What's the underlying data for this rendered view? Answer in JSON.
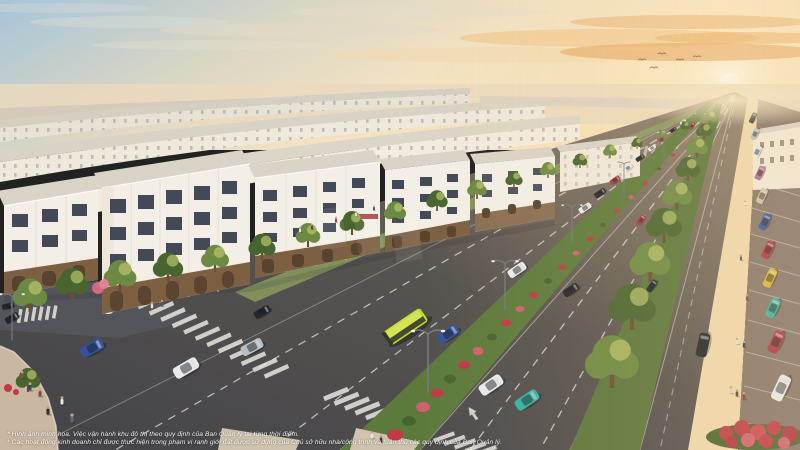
{
  "disclaimer": {
    "line1": "* Hình ảnh minh họa. Việc vận hành khu đô thị theo quy định của Ban Quản lý tại từng thời điểm.",
    "line2": "* Các hoạt động kinh doanh chỉ được thực hiện trong phạm vi ranh giới đất được sử dụng của Chủ sở hữu nhà/công trình và tuân thủ các quy định của Ban Quản lý."
  },
  "colors": {
    "sky_top": "#a9c6d8",
    "sky_warm": "#f4e0bb",
    "sun_glow": "#fff6dc",
    "cloud_orange": "#efae6f",
    "haze": "#e9dac0",
    "building_white": "#f3efe6",
    "building_shade": "#e6e0d3",
    "roof_light": "#d9d4c7",
    "window_dark": "#434956",
    "storefront_brown": "#7d5f42",
    "door_dark": "#58432f",
    "asphalt": "#4c4c52",
    "asphalt_warm": "#83756a",
    "lane_white": "#e9e7e1",
    "green_dark": "#49652f",
    "green_mid": "#6d8a42",
    "green_warm": "#a4b35c",
    "flower_red": "#bf3a45",
    "flower_pink": "#d06070",
    "sidewalk_tan": "#c9b7a2",
    "walkway_bright": "#eed9ae",
    "bus_lime": "#c6d830",
    "car_blue": "#33539e",
    "car_red": "#b03340",
    "car_teal": "#31b3a4",
    "car_white": "#e9ebee",
    "car_dark": "#23262b",
    "car_silver": "#b9bec5",
    "car_yellow": "#d9b931",
    "car_violet": "#b06a9a",
    "car_beige": "#cfc2a6",
    "pole_gray": "#757a80",
    "text_white": "#ffffff"
  }
}
